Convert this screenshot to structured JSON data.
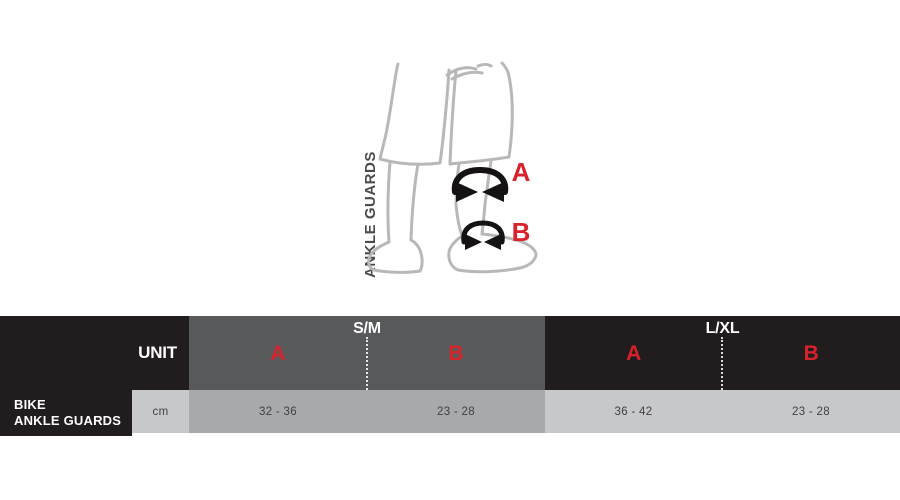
{
  "colors": {
    "black": "#211C1D",
    "header_gray": "#58595B",
    "cell_mid_gray": "#A7A9AC",
    "cell_light_gray": "#C7C8CA",
    "red": "#D8222B",
    "value_text": "#414042",
    "figure_line": "#B7B8BA",
    "band": "#151213",
    "caption_text": "#4A4B4D"
  },
  "illustration": {
    "caption": "ANKLE GUARDS",
    "markers": {
      "a": "A",
      "b": "B"
    }
  },
  "size_table": {
    "unit_header": "UNIT",
    "product_label": {
      "line1": "BIKE",
      "line2": "ANKLE GUARDS"
    },
    "unit_value": "cm",
    "groups": [
      {
        "name": "S/M",
        "col_a": "A",
        "col_b": "B",
        "val_a": "32 - 36",
        "val_b": "23 - 28"
      },
      {
        "name": "L/XL",
        "col_a": "A",
        "col_b": "B",
        "val_a": "36 - 42",
        "val_b": "23 - 28"
      }
    ]
  },
  "chart_data": {
    "type": "table",
    "title": "BIKE ANKLE GUARDS size chart",
    "unit": "cm",
    "columns": [
      "S/M A",
      "S/M B",
      "L/XL A",
      "L/XL B"
    ],
    "rows": [
      {
        "label": "BIKE ANKLE GUARDS",
        "values": [
          "32 - 36",
          "23 - 28",
          "36 - 42",
          "23 - 28"
        ]
      }
    ]
  }
}
